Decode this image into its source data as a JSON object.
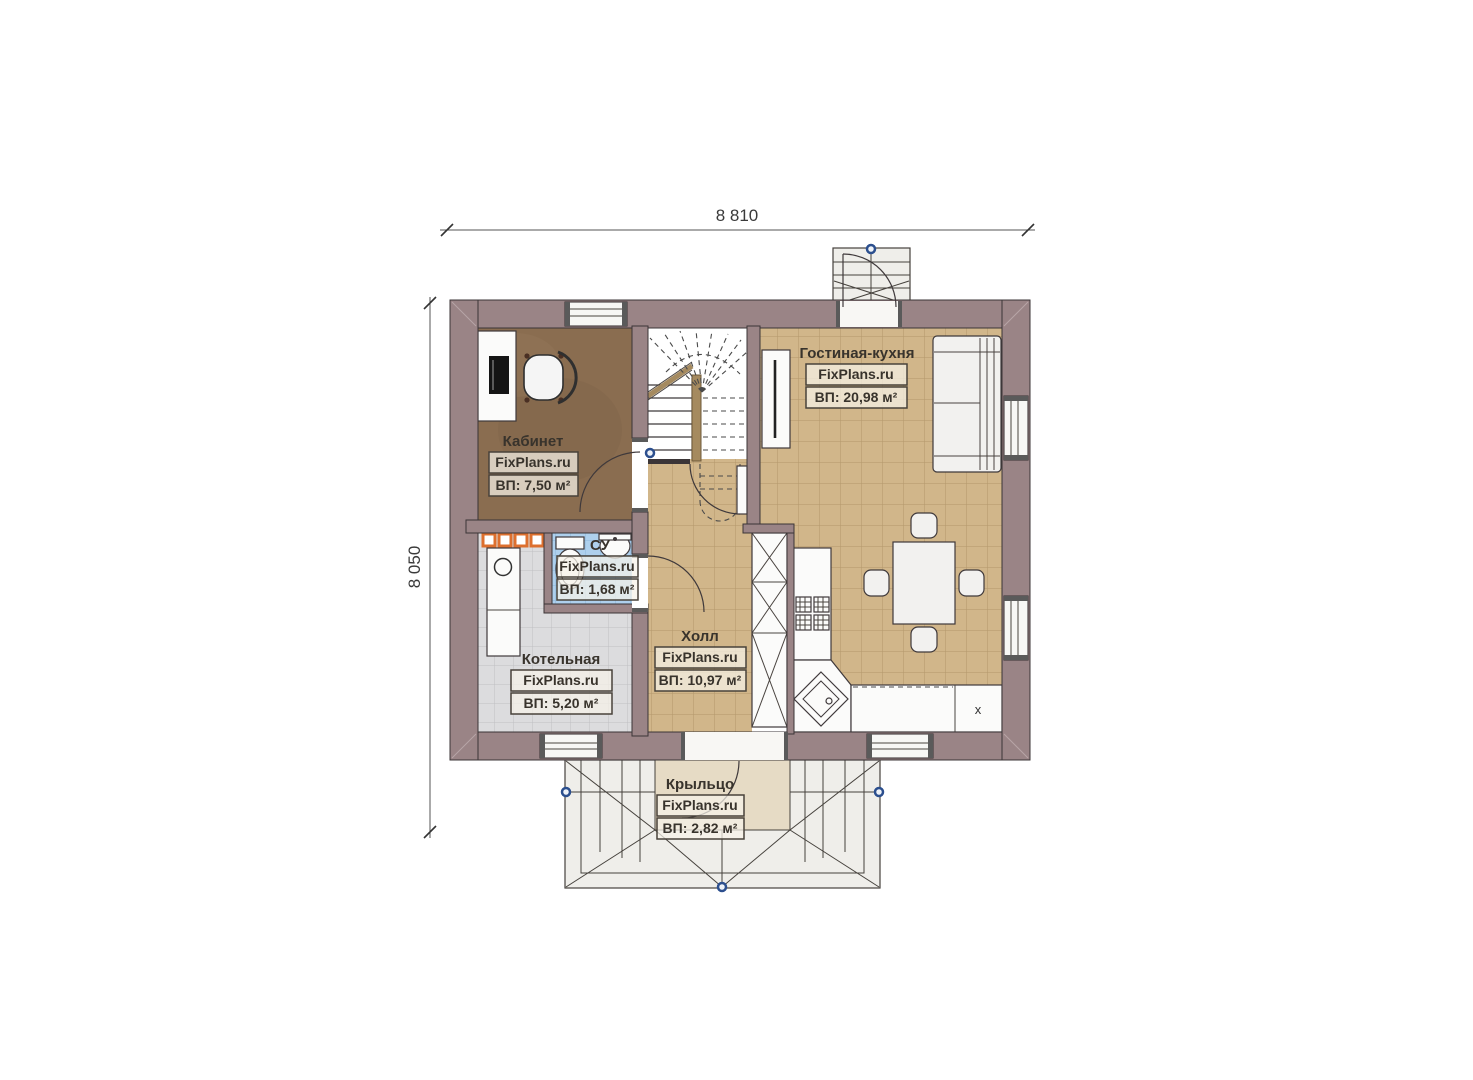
{
  "plan": {
    "title_hidden": "",
    "dimensions": {
      "width": "8 810",
      "height": "8 050"
    },
    "watermark": "FixPlans.ru",
    "rooms": [
      {
        "name": "Кабинет",
        "area": "ВП: 7,50 м²"
      },
      {
        "name": "Гостиная-кухня",
        "area": "ВП: 20,98 м²"
      },
      {
        "name": "СУ",
        "area": "ВП: 1,68 м²"
      },
      {
        "name": "Котельная",
        "area": "ВП: 5,20 м²"
      },
      {
        "name": "Холл",
        "area": "ВП: 10,97 м²"
      },
      {
        "name": "Крыльцо",
        "area": "ВП: 2,82 м²"
      }
    ],
    "kitchen": {
      "appliance_label": "x"
    },
    "colors": {
      "wall": "#9a8486",
      "office_floor": "#8a6d50",
      "tile_tan": "#d1b68a",
      "tile_gray": "#dcdcde",
      "tile_blue": "#aed0ed",
      "porch_floor": "#e6dbc5",
      "radiator_orange": "#dd6f2e",
      "marker_blue": "#2c4f8e"
    }
  }
}
